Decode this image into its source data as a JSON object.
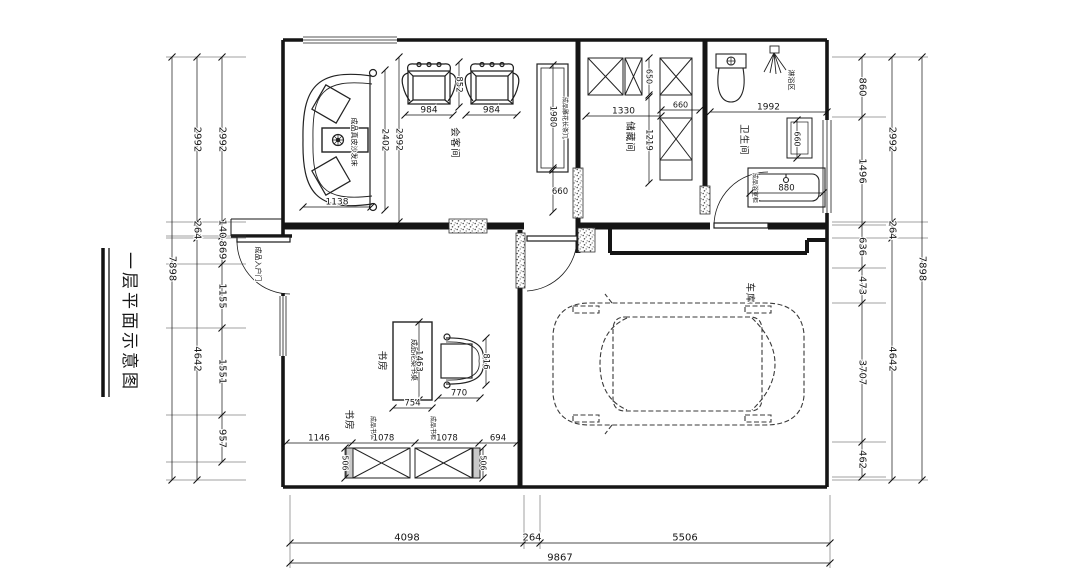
{
  "title": "一层平面示意图",
  "rooms": {
    "meeting": "会客间",
    "storage": "储藏间",
    "bath": "卫生间",
    "study1": "书房",
    "study2": "书房",
    "garage": "车库",
    "shower_zone": "淋浴区"
  },
  "furniture": {
    "sofa": "成品真皮沙发床",
    "console": "成品雕花长条几",
    "entry_door": "成品入户门",
    "desk": "成品花梨书桌",
    "bookcase1": "成品书柜",
    "bookcase2": "成品书柜",
    "vanity": "成品浴室柜"
  },
  "dims": {
    "left_outer": [
      "7898"
    ],
    "left_mid": [
      "2992",
      "264",
      "4642"
    ],
    "left_inner": [
      "2992",
      "140",
      "869",
      "1155",
      "1551",
      "957"
    ],
    "right_inner": [
      "860",
      "1496",
      "636",
      "473",
      "3707",
      "462"
    ],
    "right_mid": [
      "2992",
      "264",
      "4642"
    ],
    "right_outer": [
      "7898"
    ],
    "bottom_inner": [
      "4098",
      "264",
      "5506"
    ],
    "bottom_outer": [
      "9867"
    ],
    "sofa_length": [
      "2402"
    ],
    "sofa_width": [
      "1138"
    ],
    "meeting_height": [
      "2992"
    ],
    "armchair1": [
      "984"
    ],
    "armchair2": [
      "984"
    ],
    "armchair_gap": [
      "852"
    ],
    "console_length": [
      "1980"
    ],
    "console_below": [
      "660"
    ],
    "storage_cab_top": [
      "650"
    ],
    "storage_width": [
      "1330"
    ],
    "storage_height": [
      "1219"
    ],
    "storage_cab_right": [
      "660"
    ],
    "bath_width": [
      "1992"
    ],
    "bath_cabinet": [
      "660"
    ],
    "vanity_width": [
      "880"
    ],
    "desk_length": [
      "1463"
    ],
    "desk_width": [
      "754"
    ],
    "desk_chair_w": [
      "770"
    ],
    "desk_chair_h": [
      "816"
    ],
    "bookcase_row": [
      "1146",
      "1078",
      "1078",
      "694"
    ],
    "bookcase_d_left": [
      "506"
    ],
    "bookcase_d_right": [
      "506"
    ]
  }
}
